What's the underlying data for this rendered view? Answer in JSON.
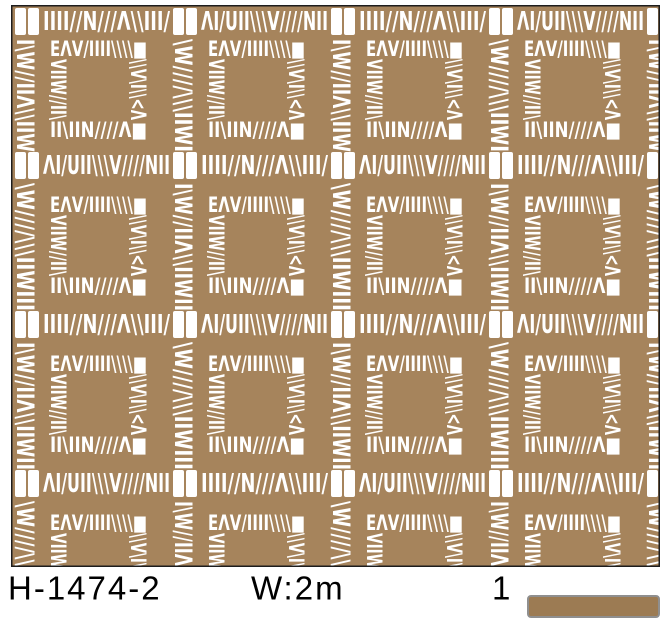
{
  "product": {
    "code": "H-1474-2",
    "width_label": "W:2m",
    "quantity": "1"
  },
  "colors": {
    "page_background": "#ffffff",
    "text": "#000000",
    "pattern_background": "#a6845c",
    "pattern_marks": "#ffffff",
    "pattern_border": "#1d1d1d",
    "swatch_fill": "#9c7b53",
    "swatch_border": "#8f8f8f"
  },
  "pattern": {
    "description": "tribal tally-mark squares grid",
    "grid_columns": 4,
    "grid_rows": 4,
    "h_bands": [
      "IIII//N///Λ\\\\III/",
      "ΛI/UII\\\\\\V////NII"
    ],
    "v_bands": [
      "I\\W//IIΛ\\\\IIWII",
      "\\W////\\\\\\IIWIII"
    ],
    "square": {
      "top": "EΛV/IIII\\\\\\\\■",
      "bottom": "II\\IIN////Λ■",
      "left": "VIIW//II\\",
      "right": "\\\\V\\I\\\\<Λ"
    }
  }
}
